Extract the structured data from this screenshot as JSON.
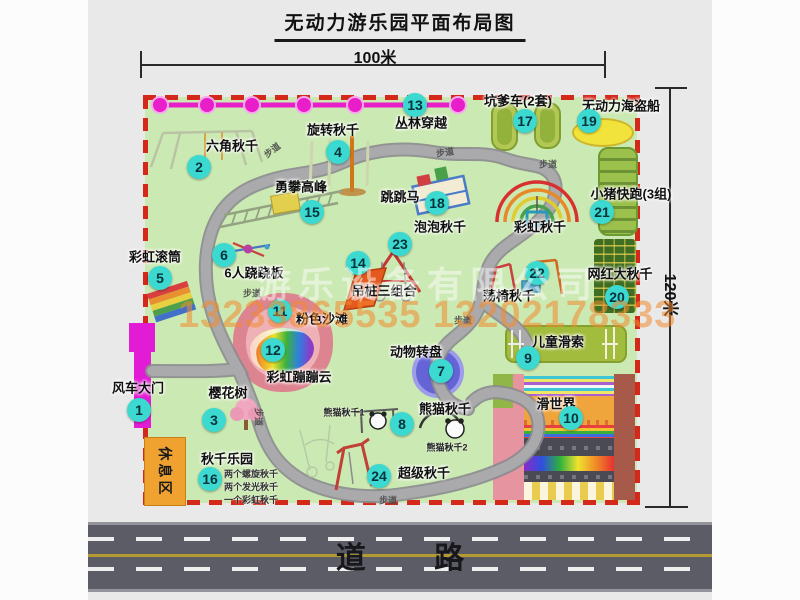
{
  "title": "无动力游乐园平面布局图",
  "dimensions": {
    "width_label": "100米",
    "height_label": "120米"
  },
  "road": {
    "label": "道  路"
  },
  "watermark": {
    "company": "游乐设备有限公司",
    "phone": "13233865535 13202178333"
  },
  "rest_area": {
    "label": "休息区"
  },
  "rainbow_swing_label": "彩虹秋千",
  "path_label": "步道",
  "attractions": [
    {
      "num": 1,
      "name": "风车大门"
    },
    {
      "num": 2,
      "name": "六角秋千"
    },
    {
      "num": 3,
      "name": "樱花树"
    },
    {
      "num": 4,
      "name": "旋转秋千"
    },
    {
      "num": 5,
      "name": "彩虹滚筒"
    },
    {
      "num": 6,
      "name": "6人跷跷板"
    },
    {
      "num": 7,
      "name": "动物转盘"
    },
    {
      "num": 8,
      "name": "熊猫秋千"
    },
    {
      "num": 9,
      "name": "儿童滑索"
    },
    {
      "num": 10,
      "name": "滑世界"
    },
    {
      "num": 11,
      "name": "粉色沙滩"
    },
    {
      "num": 12,
      "name": "彩虹蹦蹦云"
    },
    {
      "num": 13,
      "name": "丛林穿越"
    },
    {
      "num": 14,
      "name": "吊桩三组合"
    },
    {
      "num": 15,
      "name": "勇攀高峰"
    },
    {
      "num": 16,
      "name": "秋千乐园"
    },
    {
      "num": 17,
      "name": "坑爹车(2套)"
    },
    {
      "num": 18,
      "name": "跳跳马"
    },
    {
      "num": 19,
      "name": "无动力海盗船"
    },
    {
      "num": 20,
      "name": "网红大秋千"
    },
    {
      "num": 21,
      "name": "小猪快跑(3组)"
    },
    {
      "num": 22,
      "name": "荡椅秋千"
    },
    {
      "num": 23,
      "name": "泡泡秋千"
    },
    {
      "num": 24,
      "name": "超级秋千"
    }
  ],
  "swing_park_notes": [
    "两个螺旋秋千",
    "两个发光秋千",
    "一个彩虹秋千"
  ],
  "panda_sub_labels": [
    "熊猫秋千1",
    "熊猫秋千2"
  ],
  "colors": {
    "map_green": "#cbe9b2",
    "border_red": "#d4281a",
    "marker_cyan": "#3bd9cf",
    "jungle_magenta": "#e81ec8",
    "road_gray": "#5c5c66",
    "rest_orange": "#f0a231"
  }
}
